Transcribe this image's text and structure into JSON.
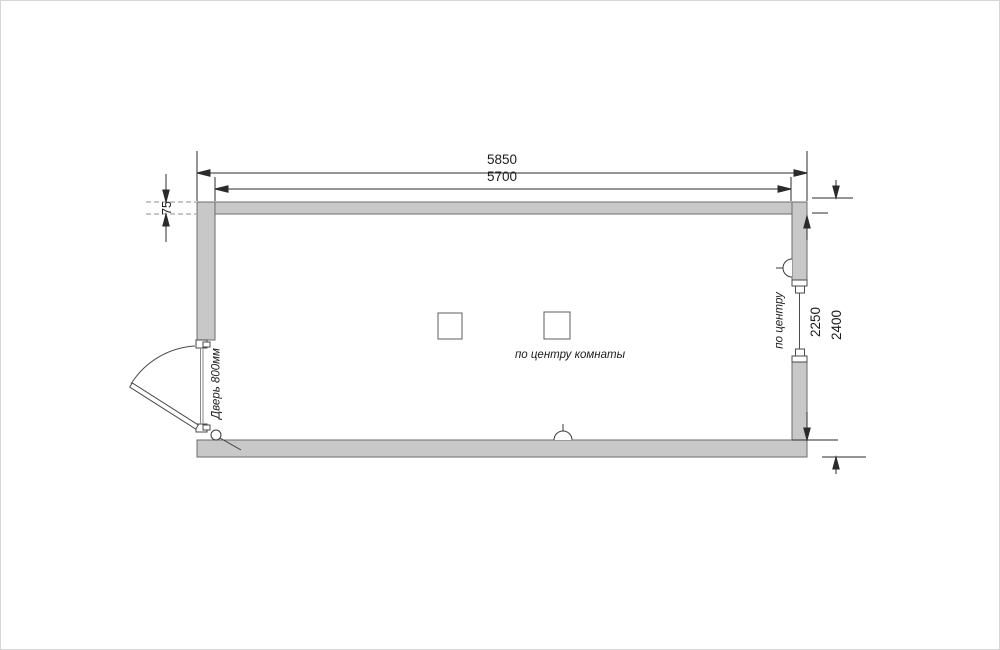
{
  "drawing": {
    "type": "floor-plan",
    "dimensions": {
      "overall_width": "5850",
      "inner_width": "5700",
      "wall_thickness": "75",
      "inner_depth": "2250",
      "overall_depth": "2400"
    },
    "labels": {
      "window_center": "по центру",
      "room_center": "по центру комнаты",
      "door": "Дверь 800мм"
    },
    "colors": {
      "wall_fill": "#c8c8c8",
      "wall_outline": "#6b6b6b",
      "line": "#2b2b2b",
      "background": "#ffffff"
    }
  }
}
